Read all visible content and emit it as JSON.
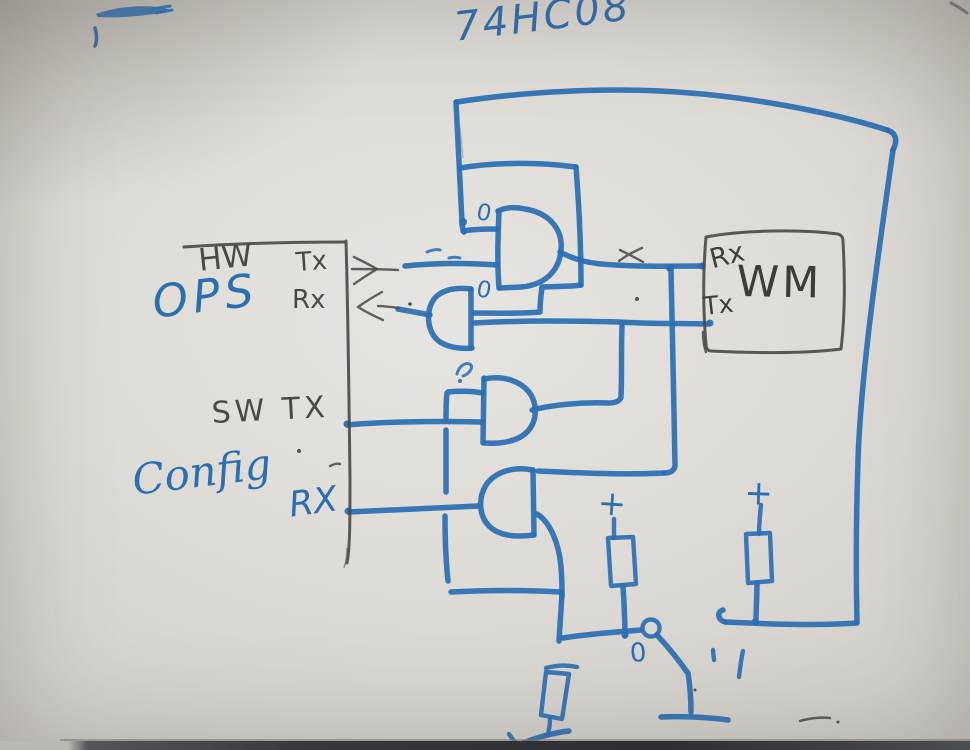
{
  "labels": {
    "chip": "74HC08",
    "hw": "HW",
    "hw_tx": "Tx",
    "ops": "OPS",
    "ops_rx": "Rx",
    "sw_tx": "SW TX",
    "config": "Config",
    "config_rx": "RX",
    "module": "WM",
    "module_rx": "Rx",
    "module_tx": "Tx"
  },
  "annotations": {
    "gate1_zero": "0",
    "gate2_zero": "0",
    "switch_zero": "0",
    "pullup_left_plus": "+",
    "pullup_right_plus": "+"
  },
  "colors": {
    "blue_marker": "#2b6fb3",
    "black_marker": "#4b4947",
    "whiteboard": "#dcd9d4",
    "tray_dark": "#38383c"
  }
}
